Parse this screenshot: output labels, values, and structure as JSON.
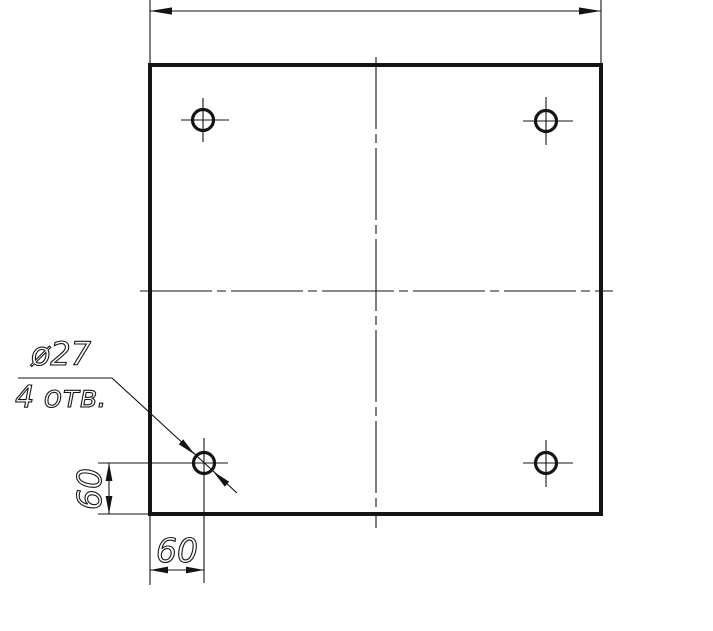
{
  "drawing": {
    "type": "engineering-drawing",
    "view": "square plate, front view, 4 through holes",
    "labels": {
      "hole_diameter": "ø27",
      "hole_count": "4 отв.",
      "dim_vertical": "60",
      "dim_horizontal": "60"
    },
    "holes": {
      "count": 4,
      "diameter_label": "ø27",
      "offset_from_left_edge": "60",
      "offset_from_bottom_edge": "60"
    },
    "colors": {
      "line": "#141414",
      "background": "#ffffff"
    }
  }
}
